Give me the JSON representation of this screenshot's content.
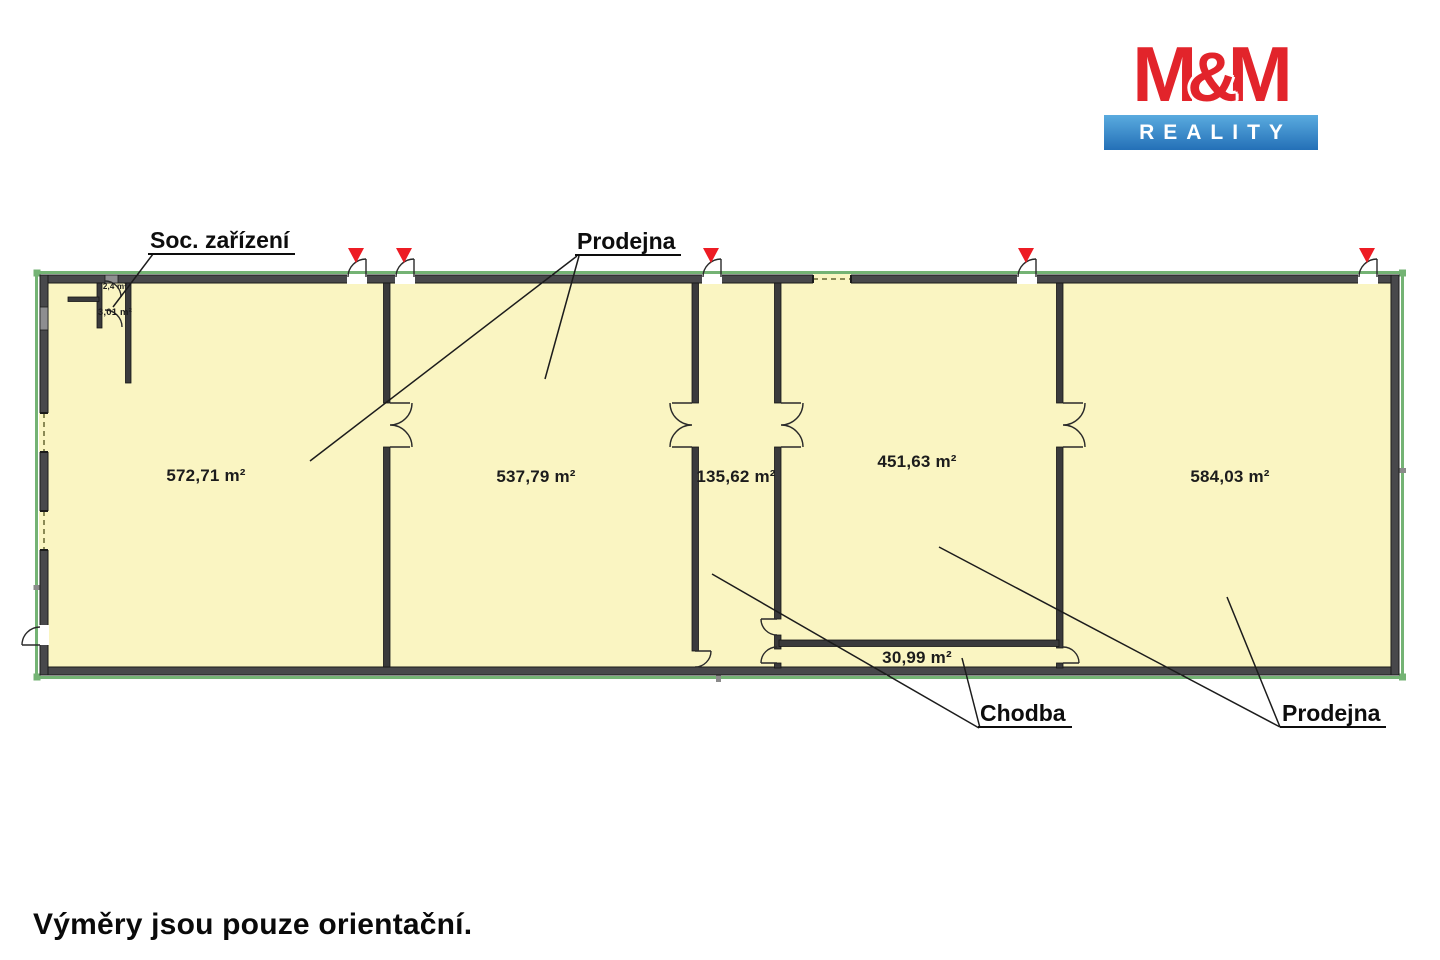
{
  "logo": {
    "m1": "M",
    "amp": "&",
    "m2": "M",
    "sub": "REALITY"
  },
  "callouts": {
    "soc_zarizeni": "Soc. zařízení",
    "prodejna_top": "Prodejna",
    "chodba": "Chodba",
    "prodejna_bottom": "Prodejna"
  },
  "rooms": [
    {
      "name": "Prodejna",
      "area": "572,71 m²"
    },
    {
      "name": "Prodejna",
      "area": "537,79 m²"
    },
    {
      "name": "Chodba",
      "area": "135,62 m²"
    },
    {
      "name": "Prodejna",
      "area": "451,63 m²"
    },
    {
      "name": "Prodejna",
      "area": "584,03 m²"
    },
    {
      "name": "Chodba",
      "area": "30,99 m²"
    },
    {
      "name": "Soc. zařízení",
      "area": "2,4 m²"
    },
    {
      "name": "Soc. zařízení",
      "area": "3,01 m²"
    }
  ],
  "footnote": "Výměry jsou pouze orientační.",
  "colors": {
    "room_fill": "#faf5c2",
    "wall_dark": "#3a3a3c",
    "outer_wall": "#4a4a4c",
    "plot_outline_green": "#74b374",
    "entrance_marker_red": "#ed1c24",
    "logo_red": "#e2242b",
    "logo_blue": "#2470b7"
  }
}
